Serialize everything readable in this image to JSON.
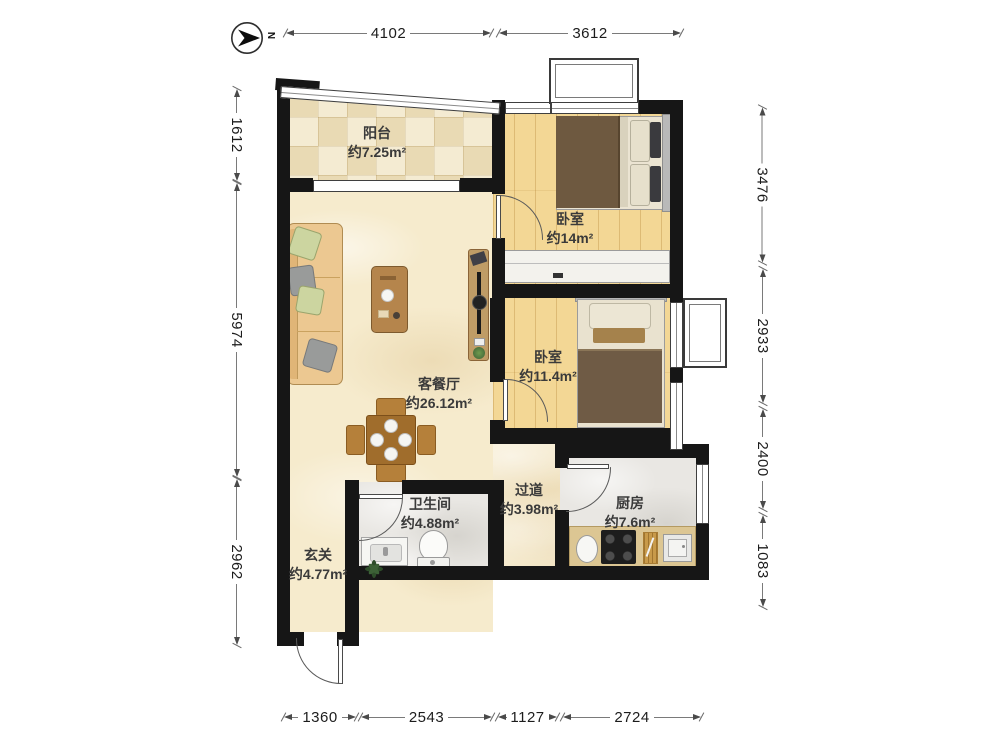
{
  "compass": {
    "label": "N"
  },
  "rooms": {
    "balcony": {
      "name": "阳台",
      "area": "约7.25m²"
    },
    "bedroom_top": {
      "name": "卧室",
      "area": "约14m²"
    },
    "bedroom_mid": {
      "name": "卧室",
      "area": "约11.4m²"
    },
    "living": {
      "name": "客餐厅",
      "area": "约26.12m²"
    },
    "hallway": {
      "name": "过道",
      "area": "约3.98m²"
    },
    "kitchen": {
      "name": "厨房",
      "area": "约7.6m²"
    },
    "bathroom": {
      "name": "卫生间",
      "area": "约4.88m²"
    },
    "entry": {
      "name": "玄关",
      "area": "约4.77m²"
    }
  },
  "dimensions": {
    "top": [
      "4102",
      "3612"
    ],
    "bottom": [
      "1360",
      "2543",
      "1127",
      "2724"
    ],
    "left": [
      "1612",
      "5974",
      "2962"
    ],
    "right": [
      "3476",
      "2933",
      "2400",
      "1083"
    ]
  }
}
